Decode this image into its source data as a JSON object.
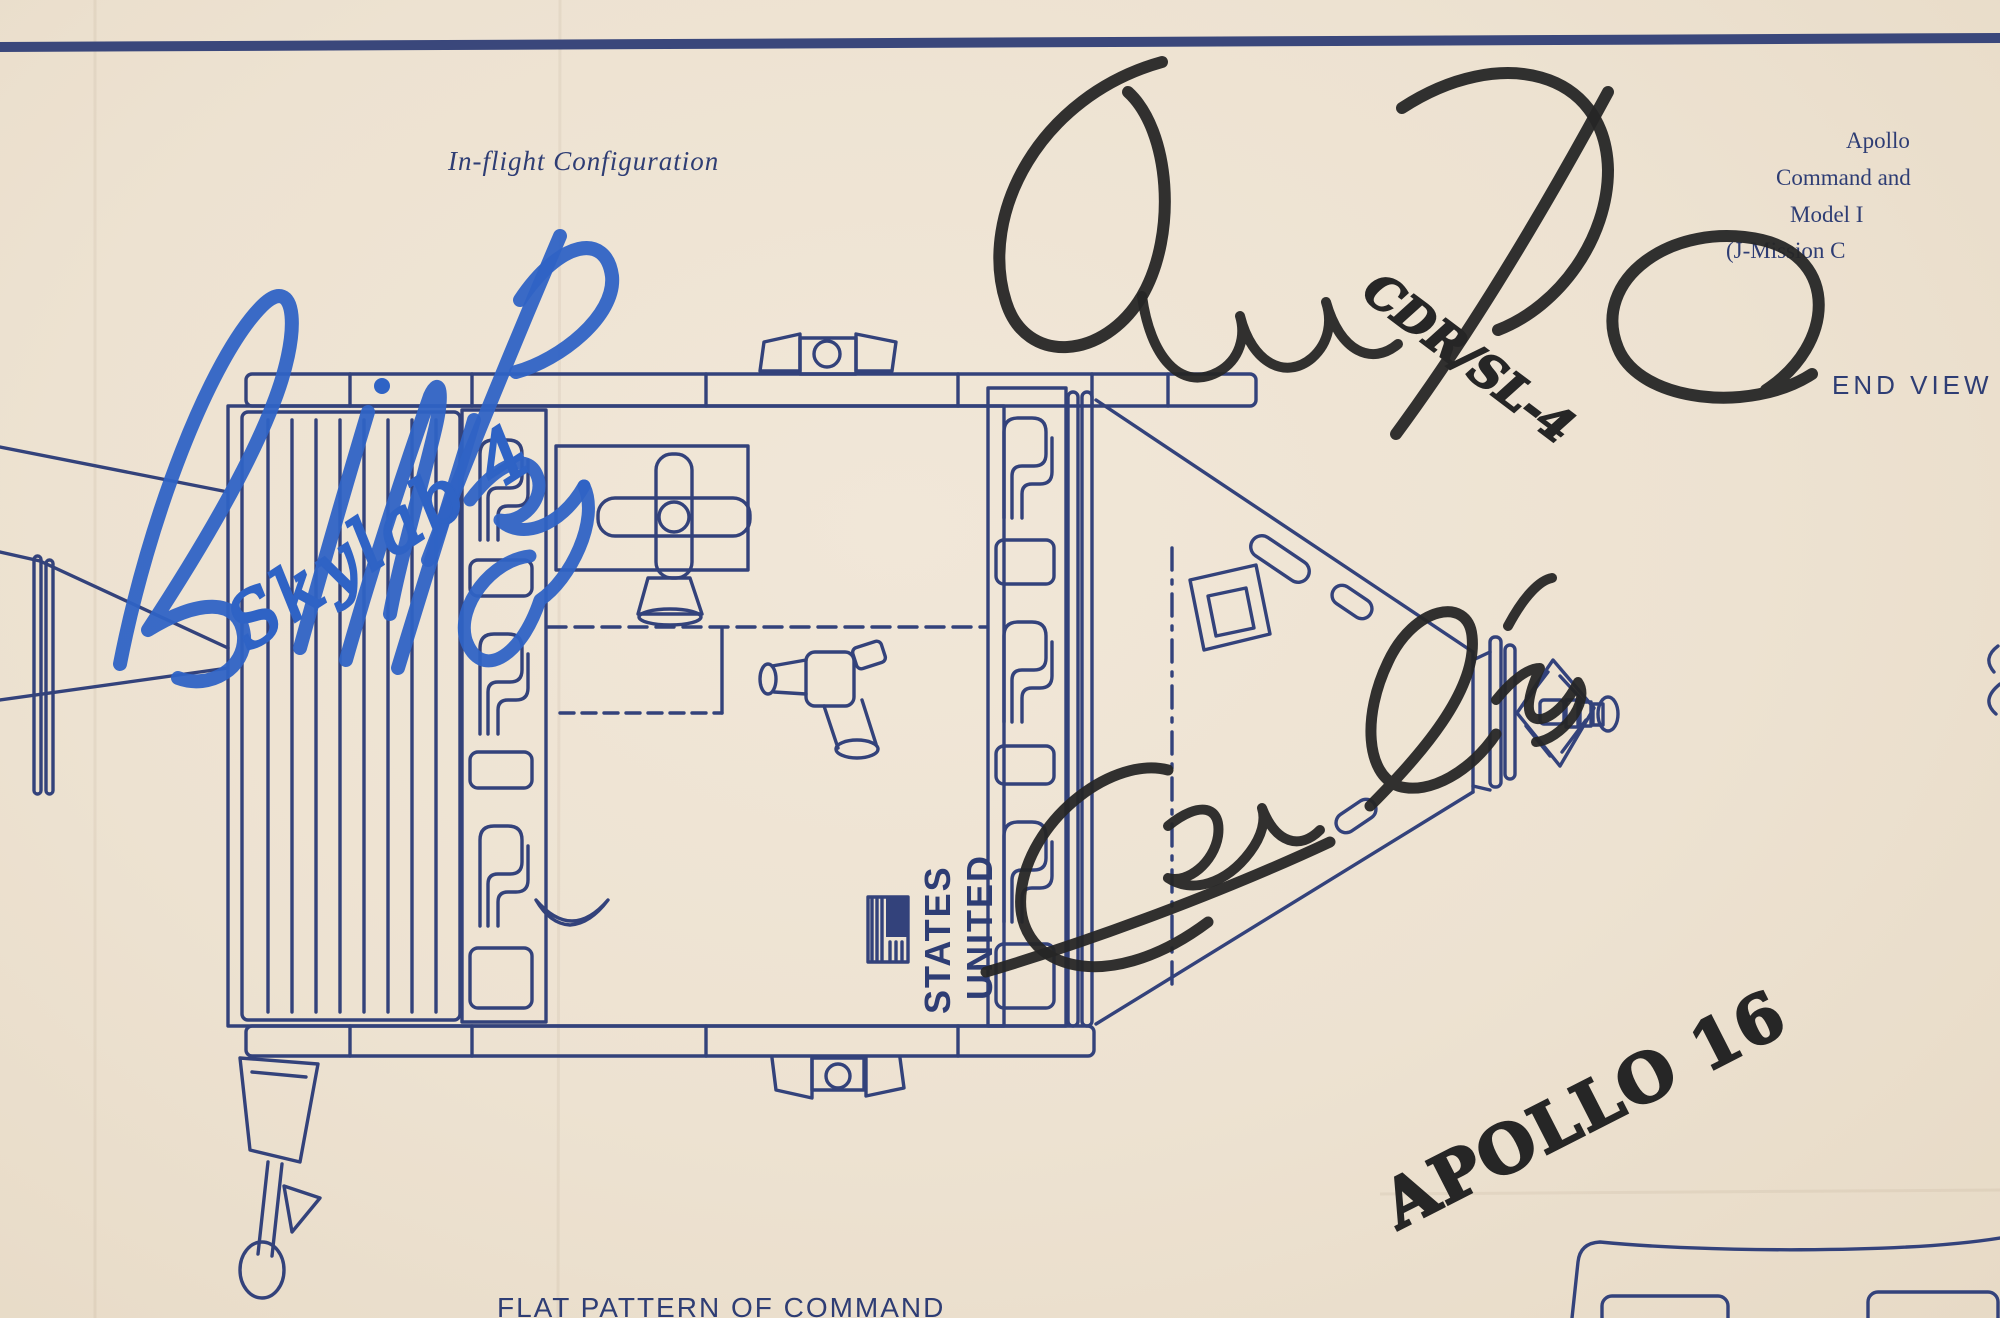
{
  "colors": {
    "paper": "#ede2d1",
    "ink_blue": "#33427b",
    "marker_black": "#262626",
    "marker_blue": "#2f63c5"
  },
  "labels": {
    "configuration_title": "In-flight Configuration",
    "end_view": "END VIEW",
    "bottom_caption": "FLAT PATTERN OF COMMAND"
  },
  "corner_block": {
    "lines": [
      "Apollo",
      "Command and",
      "Model I",
      "(J-Mission C"
    ]
  },
  "spacecraft_markings": {
    "flag_icon": "us-flag",
    "word_top": "UNITED",
    "word_bottom": "STATES"
  },
  "signatures": [
    {
      "name": "Jerry Carr",
      "annotation": "CDR/SL-4",
      "ink": "#262626"
    },
    {
      "name": "Bill Pogue",
      "annotation": "Skylab 4",
      "ink": "#2f63c5"
    },
    {
      "name": "Charlie Duke",
      "annotation": "APOLLO 16",
      "ink": "#262626"
    }
  ]
}
